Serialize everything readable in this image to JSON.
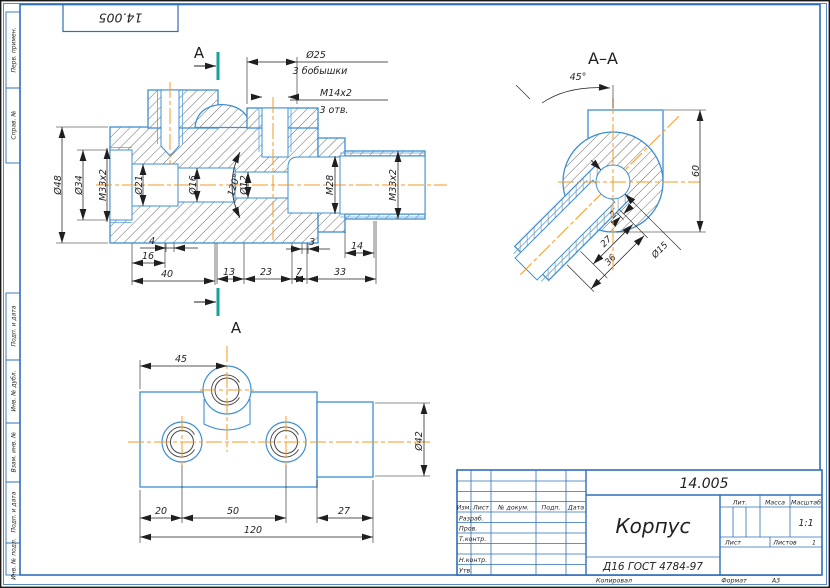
{
  "corner_code": "14.005",
  "margin_labels": [
    "Перв. примен.",
    "Справ. №",
    "Подп. и дата",
    "Инв. № дубл.",
    "Взам. инв. №",
    "Подп. и дата",
    "Инв. № подл."
  ],
  "front_view": {
    "section_letter": "А",
    "callout_dia": "Ø25",
    "callout_bosses": "3 бобышки",
    "callout_thread": "M14x2",
    "callout_holes": "3 отв.",
    "dia48": "Ø48",
    "dia34": "Ø34",
    "m33_left": "M33x2",
    "dia21": "Ø21",
    "dia16": "Ø16",
    "dia12": "Ø12",
    "angle120": "120°",
    "m28": "M28",
    "m33_right": "M33x2",
    "d4": "4",
    "d16": "16",
    "d40": "40",
    "d3": "3",
    "d13": "13",
    "d23": "23",
    "d7": "7",
    "d33": "33",
    "d14": "14"
  },
  "section_view": {
    "title": "А–А",
    "angle45": "45°",
    "d2": "2",
    "d27": "27",
    "d36": "36",
    "d60": "60",
    "dia15": "Ø15"
  },
  "bottom_view": {
    "d45": "45",
    "d20": "20",
    "d50": "50",
    "d27": "27",
    "d120": "120",
    "dia42": "Ø42"
  },
  "title_block": {
    "doc_number": "14.005",
    "part_name": "Корпус",
    "material": "Д16 ГОСТ 4784-97",
    "col_izm": "Изм.",
    "col_list": "Лист",
    "col_ndoc": "№ докум.",
    "col_podp": "Подп.",
    "col_data": "Дата",
    "row_razrab": "Разраб.",
    "row_prov": "Пров.",
    "row_tkontr": "Т.контр.",
    "row_nkontr": "Н.контр.",
    "row_utv": "Утв.",
    "lit": "Лит.",
    "massa": "Масса",
    "masshtab": "Масштаб",
    "scale_value": "1:1",
    "list_label": "Лист",
    "listov_label": "Листов",
    "listov_value": "1",
    "kopiroval": "Копировал",
    "format_label": "Формат",
    "format_value": "А3"
  },
  "colors": {
    "outline": "#3f8fd2",
    "frame": "#2e6fb8",
    "centerline": "#f59a23",
    "section_mark": "#12a39a",
    "dim": "#1f1f1f"
  }
}
